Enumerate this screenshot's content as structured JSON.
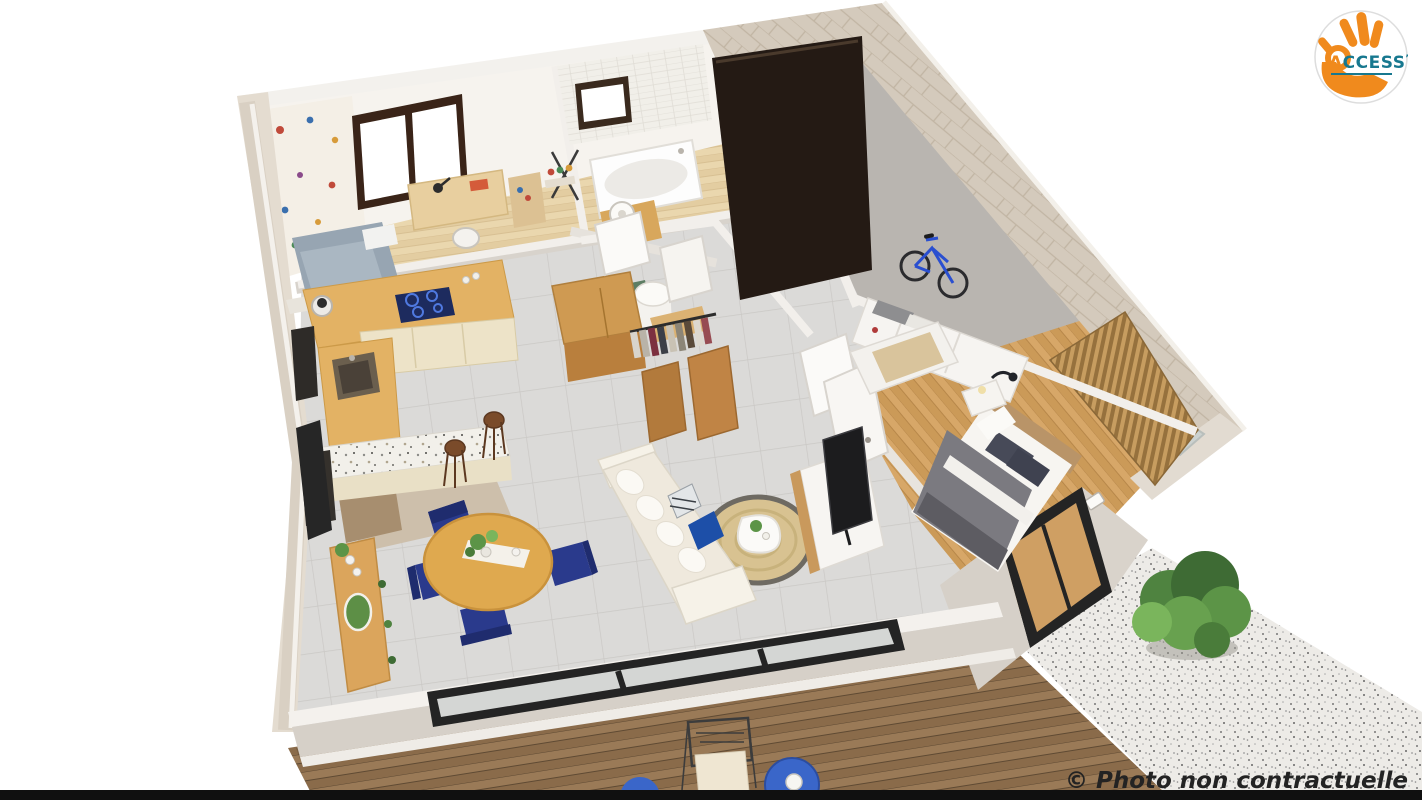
{
  "logo": {
    "text": "ACCESS",
    "text_accent": "A",
    "text_rest": "CCESS",
    "registered_mark": "’",
    "colors": {
      "circle_bg": "#FFFFFF",
      "circle_border": "#DDDDDD",
      "hand_orange": "#F08A1D",
      "text_orange": "#F08A1D",
      "text_teal": "#17788F"
    }
  },
  "watermark": {
    "text": "© Photo non contractuelle",
    "color": "#232323"
  },
  "palette": {
    "background": "#FFFFFF",
    "bottom_bar": "#101010",
    "exterior_wall": "#D6D0C8",
    "stone_wall": "#D4CABC",
    "interior_wall": "#F2EFEB",
    "tile_floor": "#DBDAD8",
    "wood_floor_light": "#EAD7AE",
    "wood_floor_honey": "#D5A564",
    "garage_floor": "#B9B5B0",
    "garage_door": "#241A14",
    "kitchen_counter": "#E3B264",
    "kitchen_cabinet": "#EDE3C8",
    "hob_blue": "#1D2B5E",
    "dining_table": "#DFA94F",
    "chair_navy": "#2A3A8C",
    "sofa_cream": "#EFE9DD",
    "rug_jute": "#D8C291",
    "accent_pillow_blue": "#1D4FA8",
    "bed_duvet_gray": "#7B7A80",
    "deck_wood": "#9A7A57",
    "gravel": "#EDEBE7",
    "plant_green": "#4F8340",
    "bike_blue": "#2A4FD0"
  }
}
